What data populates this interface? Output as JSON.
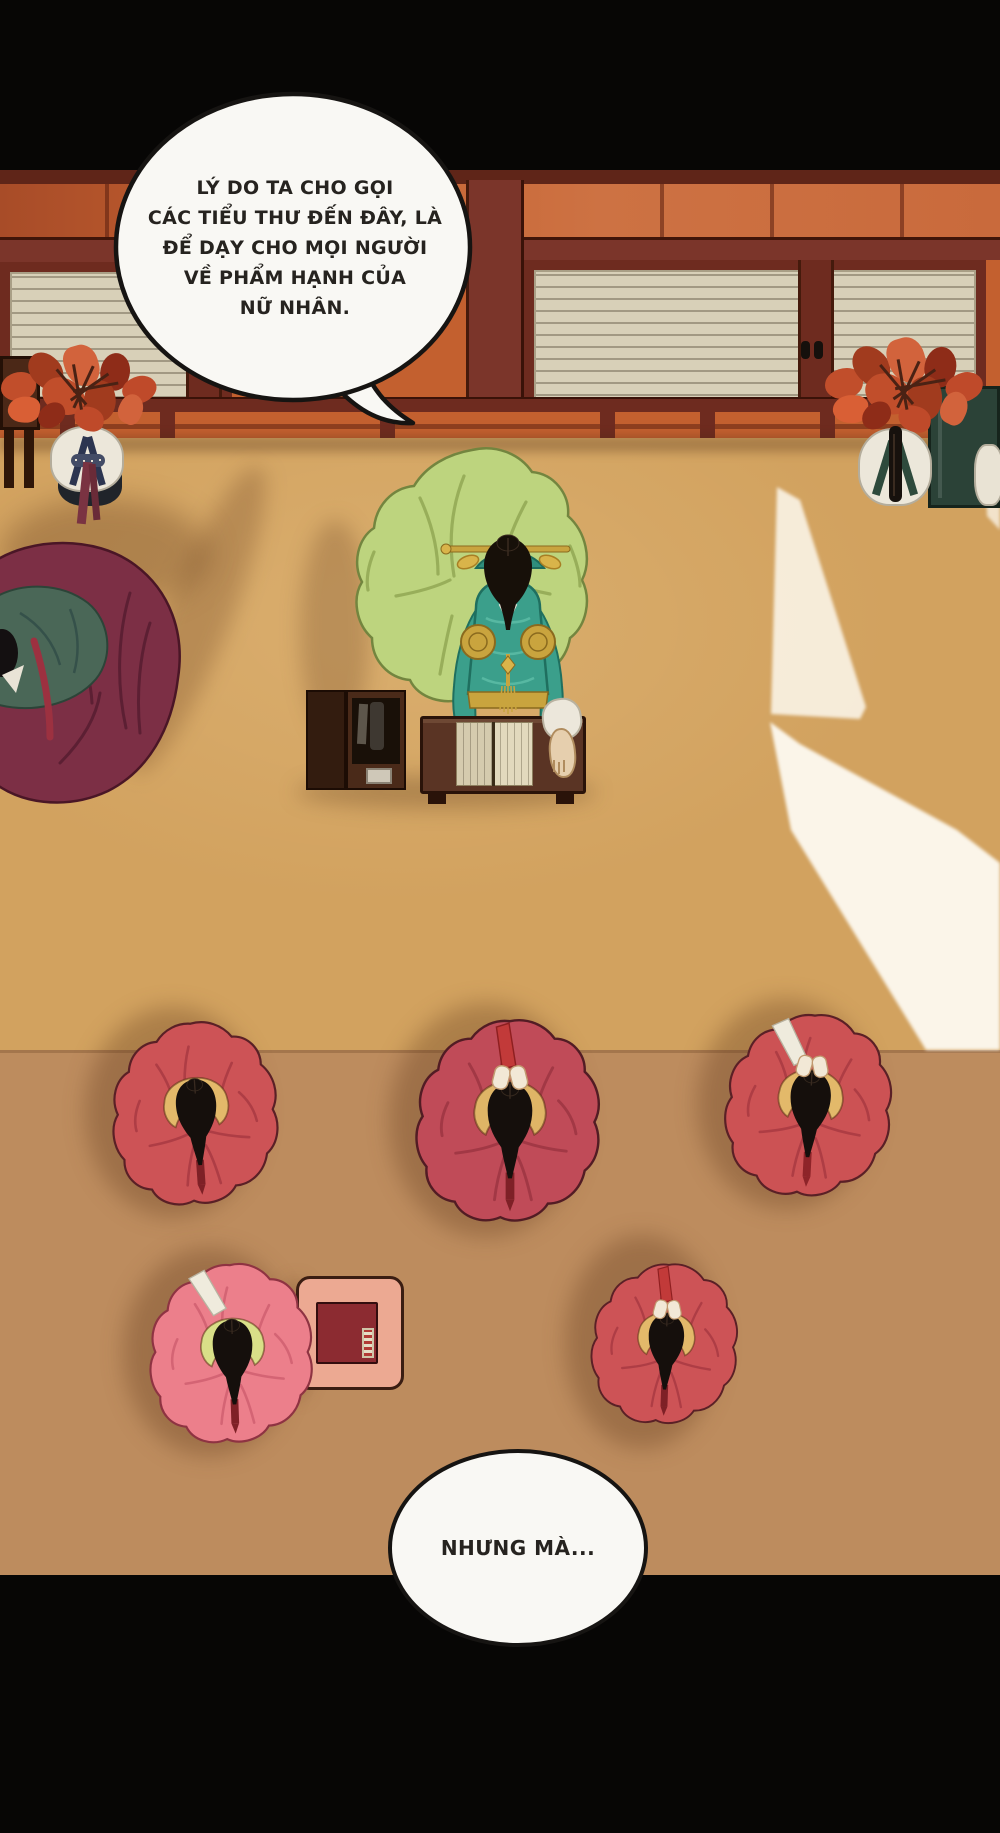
{
  "panel": {
    "type": "webtoon-comic-panel",
    "description": "Top-down view of a Korean palace room: a teacher in green hanbok at a reading desk, five students in red and pink hanbok bowing on the floor, two attendants with red flower headpieces by the wall, sunlight beams on the floor",
    "background": "#070605"
  },
  "bubbles": {
    "top": {
      "lines": [
        "LÝ DO TA CHO GỌI",
        "CÁC TIỂU THƯ ĐẾN ĐÂY, LÀ",
        "ĐỂ DẠY CHO MỌI NGƯỜI",
        "VỀ PHẨM HẠNH CỦA",
        "NỮ NHÂN."
      ]
    },
    "bottom": {
      "lines": [
        "NHƯNG MÀ..."
      ]
    }
  },
  "palette": {
    "gutter_black": "#070605",
    "floor_upper": "#d2a25f",
    "floor_lower": "#bd8c5e",
    "wall_orange": "#c3602f",
    "wood_dark_red": "#7b352a",
    "door_paper": "#d8d0b8",
    "bubble_fill": "#f9f8f4",
    "bubble_stroke": "#161412",
    "student_red": "#cd5356",
    "student_pink": "#ec7f8b",
    "teacher_green": "#bdd47e",
    "jacket_teal": "#3b9f8b",
    "gold": "#c9a43e",
    "hair_black": "#171009",
    "attendant_maroon": "#7c2f45",
    "flower_red": "#c14e2b",
    "beam_light": "#fffef8"
  },
  "scene": {
    "teacher": {
      "x": 343,
      "y": 436,
      "w": 262,
      "h": 310,
      "skirt": "#bdd47e",
      "fold": "#92a754",
      "outline": "#73853f",
      "jacket": "#3b9f8b",
      "jacketDark": "#1f6f5f",
      "gold": "#c9a43e",
      "goldLight": "#d9b44a",
      "hair": "#171009"
    },
    "students": [
      {
        "cx": 197,
        "cy": 1118,
        "w": 176,
        "h": 210,
        "rot": -4,
        "skirt": "#cd5356",
        "fold": "#a83a42",
        "outline": "#5a2026",
        "collar": "#e3b96a",
        "ribbon": "#7e2026",
        "pin": false,
        "braidUp": false,
        "hands": false
      },
      {
        "cx": 510,
        "cy": 1126,
        "w": 194,
        "h": 234,
        "rot": 0,
        "skirt": "#c04b58",
        "fold": "#9c3542",
        "outline": "#521c24",
        "collar": "#dfb566",
        "ribbon": "#7e2026",
        "pin": false,
        "braidUp": true,
        "hands": true
      },
      {
        "cx": 810,
        "cy": 1110,
        "w": 178,
        "h": 210,
        "rot": 3,
        "skirt": "#cc5254",
        "fold": "#a83a42",
        "outline": "#5a2026",
        "collar": "#e3b96a",
        "ribbon": "#8e2429",
        "pin": true,
        "braidUp": false,
        "hands": true
      },
      {
        "cx": 233,
        "cy": 1358,
        "w": 172,
        "h": 208,
        "rot": -2,
        "skirt": "#ec7f8b",
        "fold": "#d05f70",
        "outline": "#8e3342",
        "collar": "#d9df88",
        "ribbon": "#7e2026",
        "pin": true,
        "braidUp": false,
        "hands": false
      },
      {
        "cx": 666,
        "cy": 1348,
        "w": 154,
        "h": 214,
        "rot": 2,
        "skirt": "#cd5356",
        "fold": "#a83a42",
        "outline": "#5a2026",
        "collar": "#e3b96a",
        "ribbon": "#7e2026",
        "pin": false,
        "braidUp": true,
        "hands": true
      }
    ],
    "attendant_left_person": {
      "x": 0,
      "y": 533,
      "w": 196,
      "h": 290,
      "skirt": "#7c2f45",
      "fold": "#5c1f33",
      "jacket": "#4a6757",
      "jacketDark": "#35514a",
      "sash": "#9c3140"
    },
    "flower_clusters": [
      {
        "x": 6,
        "y": 356,
        "w": 152,
        "h": 84
      },
      {
        "x": 832,
        "y": 350,
        "w": 150,
        "h": 92
      }
    ],
    "flower_colors": [
      "#c14e2b",
      "#a13b1e",
      "#d2633c",
      "#8e2c18",
      "#bf4a2a",
      "#d95f35"
    ]
  }
}
